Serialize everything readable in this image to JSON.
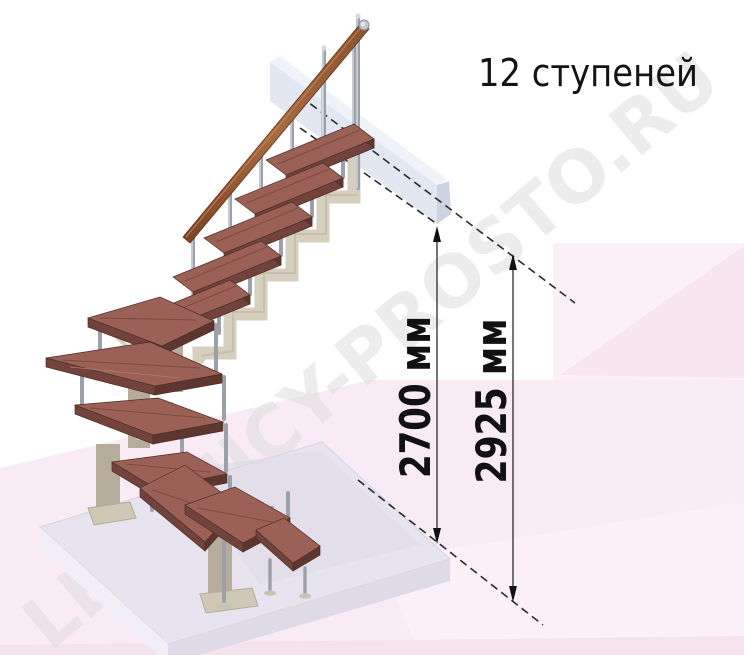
{
  "labels": {
    "steps_count": "12 ступеней",
    "dim_inner": "2700 мм",
    "dim_outer": "2925 мм"
  },
  "watermark": {
    "text": "LESTNICY-PROSTO.RU"
  },
  "diagram": {
    "type": "staircase-3d-view",
    "steps_total": 12,
    "dimensions_mm": [
      2700,
      2925
    ],
    "dimension_labels": [
      "2700 мм",
      "2925 мм"
    ]
  },
  "palette": {
    "tread_wood": "#9b6156",
    "tread_front": "#71433c",
    "frame_beige": "#d5cebc",
    "baluster_steel": "#9ba0ab",
    "handrail_wood": "#8a5430",
    "landing_gray_blue": "#e2e7f2",
    "floor_slab": "#e8e4ef",
    "background_pink": "#f9ebf3",
    "dimension_line": "#2b2b2b",
    "text": "#111111",
    "watermark_gray": "#dedede"
  }
}
